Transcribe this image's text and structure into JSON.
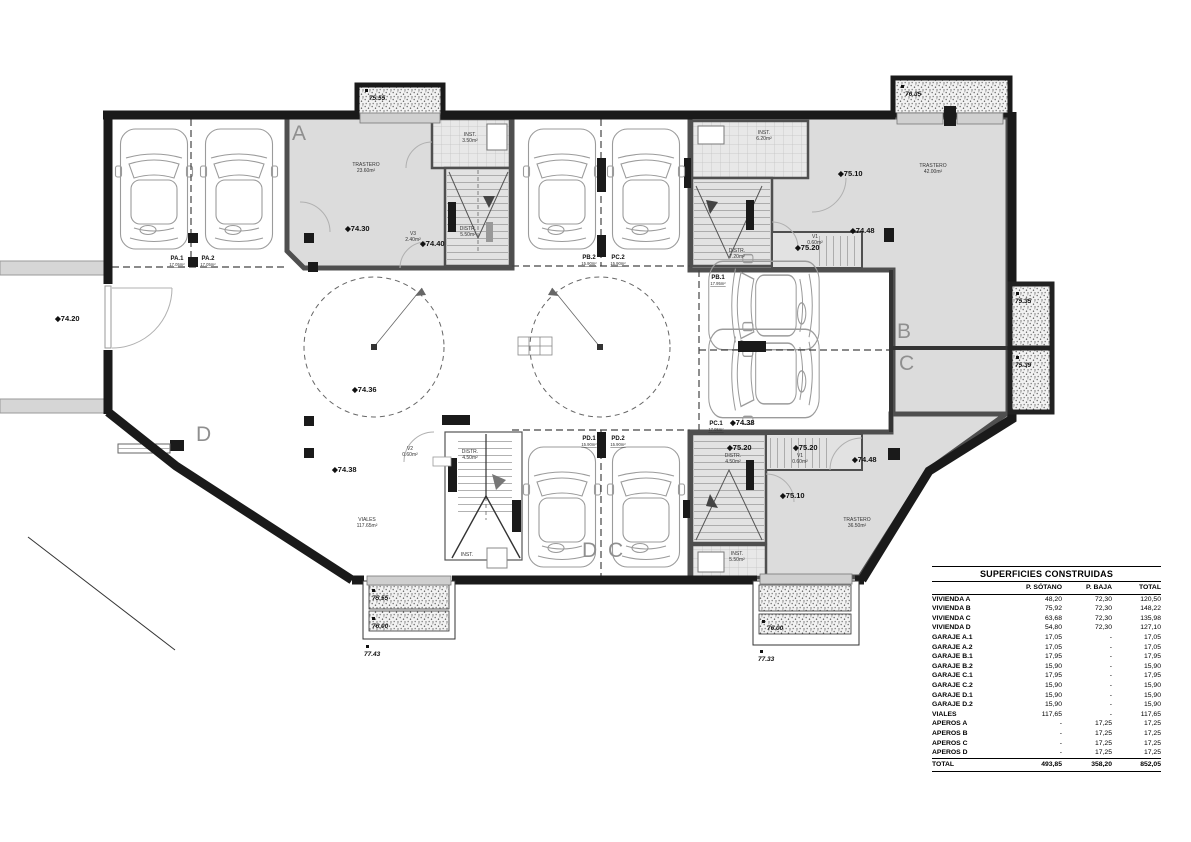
{
  "plan": {
    "sections": {
      "a": "A",
      "b": "B",
      "c": "C",
      "d": "D",
      "d_mid": "D",
      "c_mid": "C"
    },
    "levels": {
      "l74_20": "◆74.20",
      "l74_30": "◆74.30",
      "l74_40": "◆74.40",
      "l74_36": "◆74.36",
      "l74_38": "◆74.38",
      "l74_38b": "◆74.38",
      "l75_10_t": "◆75.10",
      "l75_20_t": "◆75.20",
      "l74_48_t": "◆74.48",
      "l75_10_b": "◆75.10",
      "l75_20_b1": "◆75.20",
      "l75_20_b2": "◆75.20",
      "l74_48_b": "◆74.48",
      "e75_55": "75.55",
      "e76_35": "76.35",
      "e75_35": "75.35",
      "e75_39": "75.39",
      "e75_55_bl": "75.55",
      "e76_00_bl": "76.00",
      "e77_43": "77.43",
      "e76_00_br": "76.00",
      "e77_33": "77.33"
    },
    "rooms": {
      "trastero_a": "TRASTERO",
      "trastero_a_area": "23.60m²",
      "inst_a": "INST.",
      "inst_a_area": "3.50m²",
      "distr_a": "DISTR.",
      "distr_a_area": "5.50m²",
      "v3": "V3",
      "v3_area": "2.40m²",
      "inst_tr": "INST.",
      "inst_tr_area": "6.20m²",
      "distr_tr": "DISTR.",
      "distr_tr_area": "7.20m²",
      "v1_tr": "V1",
      "v1_tr_area": "0.60m²",
      "trastero_tr": "TRASTERO",
      "trastero_tr_area": "42.00m²",
      "distr_br": "DISTR.",
      "distr_br_area": "4.50m²",
      "v1_br": "V1",
      "v1_br_area": "0.60m²",
      "trastero_br": "TRASTERO",
      "trastero_br_area": "36.50m²",
      "inst_br": "INST.",
      "inst_br_area": "5.50m²",
      "viales": "VIALES",
      "viales_area": "117.65m²",
      "v2": "V2",
      "v2_area": "0.60m²",
      "distr_d": "DISTR.",
      "distr_d_area": "4.50m²",
      "inst_d": "INST."
    },
    "parking": {
      "pa1": "PA.1",
      "pa1_area": "17.05m²",
      "pa2": "PA.2",
      "pa2_area": "17.05m²",
      "pb1": "PB.1",
      "pb1_area": "17.95m²",
      "pb2": "PB.2",
      "pb2_area": "15.90m²",
      "pc1": "PC.1",
      "pc1_area": "17.95m²",
      "pc2": "PC.2",
      "pc2_area": "15.90m²",
      "pd1": "PD.1",
      "pd1_area": "15.90m²",
      "pd2": "PD.2",
      "pd2_area": "15.90m²"
    }
  },
  "table": {
    "title": "SUPERFICIES CONSTRUIDAS",
    "col_headers": [
      "P. SÓTANO",
      "P. BAJA",
      "TOTAL"
    ],
    "rows": [
      {
        "label": "VIVIENDA A",
        "c": [
          "48,20",
          "72,30",
          "120,50"
        ]
      },
      {
        "label": "VIVIENDA B",
        "c": [
          "75,92",
          "72,30",
          "148,22"
        ]
      },
      {
        "label": "VIVIENDA C",
        "c": [
          "63,68",
          "72,30",
          "135,98"
        ]
      },
      {
        "label": "VIVIENDA D",
        "c": [
          "54,80",
          "72,30",
          "127,10"
        ]
      },
      {
        "label": "GARAJE A.1",
        "c": [
          "17,05",
          "-",
          "17,05"
        ]
      },
      {
        "label": "GARAJE A.2",
        "c": [
          "17,05",
          "-",
          "17,05"
        ]
      },
      {
        "label": "GARAJE B.1",
        "c": [
          "17,95",
          "-",
          "17,95"
        ]
      },
      {
        "label": "GARAJE B.2",
        "c": [
          "15,90",
          "-",
          "15,90"
        ]
      },
      {
        "label": "GARAJE C.1",
        "c": [
          "17,95",
          "-",
          "17,95"
        ]
      },
      {
        "label": "GARAJE C.2",
        "c": [
          "15,90",
          "-",
          "15,90"
        ]
      },
      {
        "label": "GARAJE D.1",
        "c": [
          "15,90",
          "-",
          "15,90"
        ]
      },
      {
        "label": "GARAJE D.2",
        "c": [
          "15,90",
          "-",
          "15,90"
        ]
      },
      {
        "label": "VIALES",
        "c": [
          "117,65",
          "-",
          "117,65"
        ]
      },
      {
        "label": "APEROS A",
        "c": [
          "-",
          "17,25",
          "17,25"
        ]
      },
      {
        "label": "APEROS B",
        "c": [
          "-",
          "17,25",
          "17,25"
        ]
      },
      {
        "label": "APEROS C",
        "c": [
          "-",
          "17,25",
          "17,25"
        ]
      },
      {
        "label": "APEROS D",
        "c": [
          "-",
          "17,25",
          "17,25"
        ]
      }
    ],
    "total": {
      "label": "TOTAL",
      "c": [
        "493,85",
        "358,20",
        "852,05"
      ]
    }
  }
}
